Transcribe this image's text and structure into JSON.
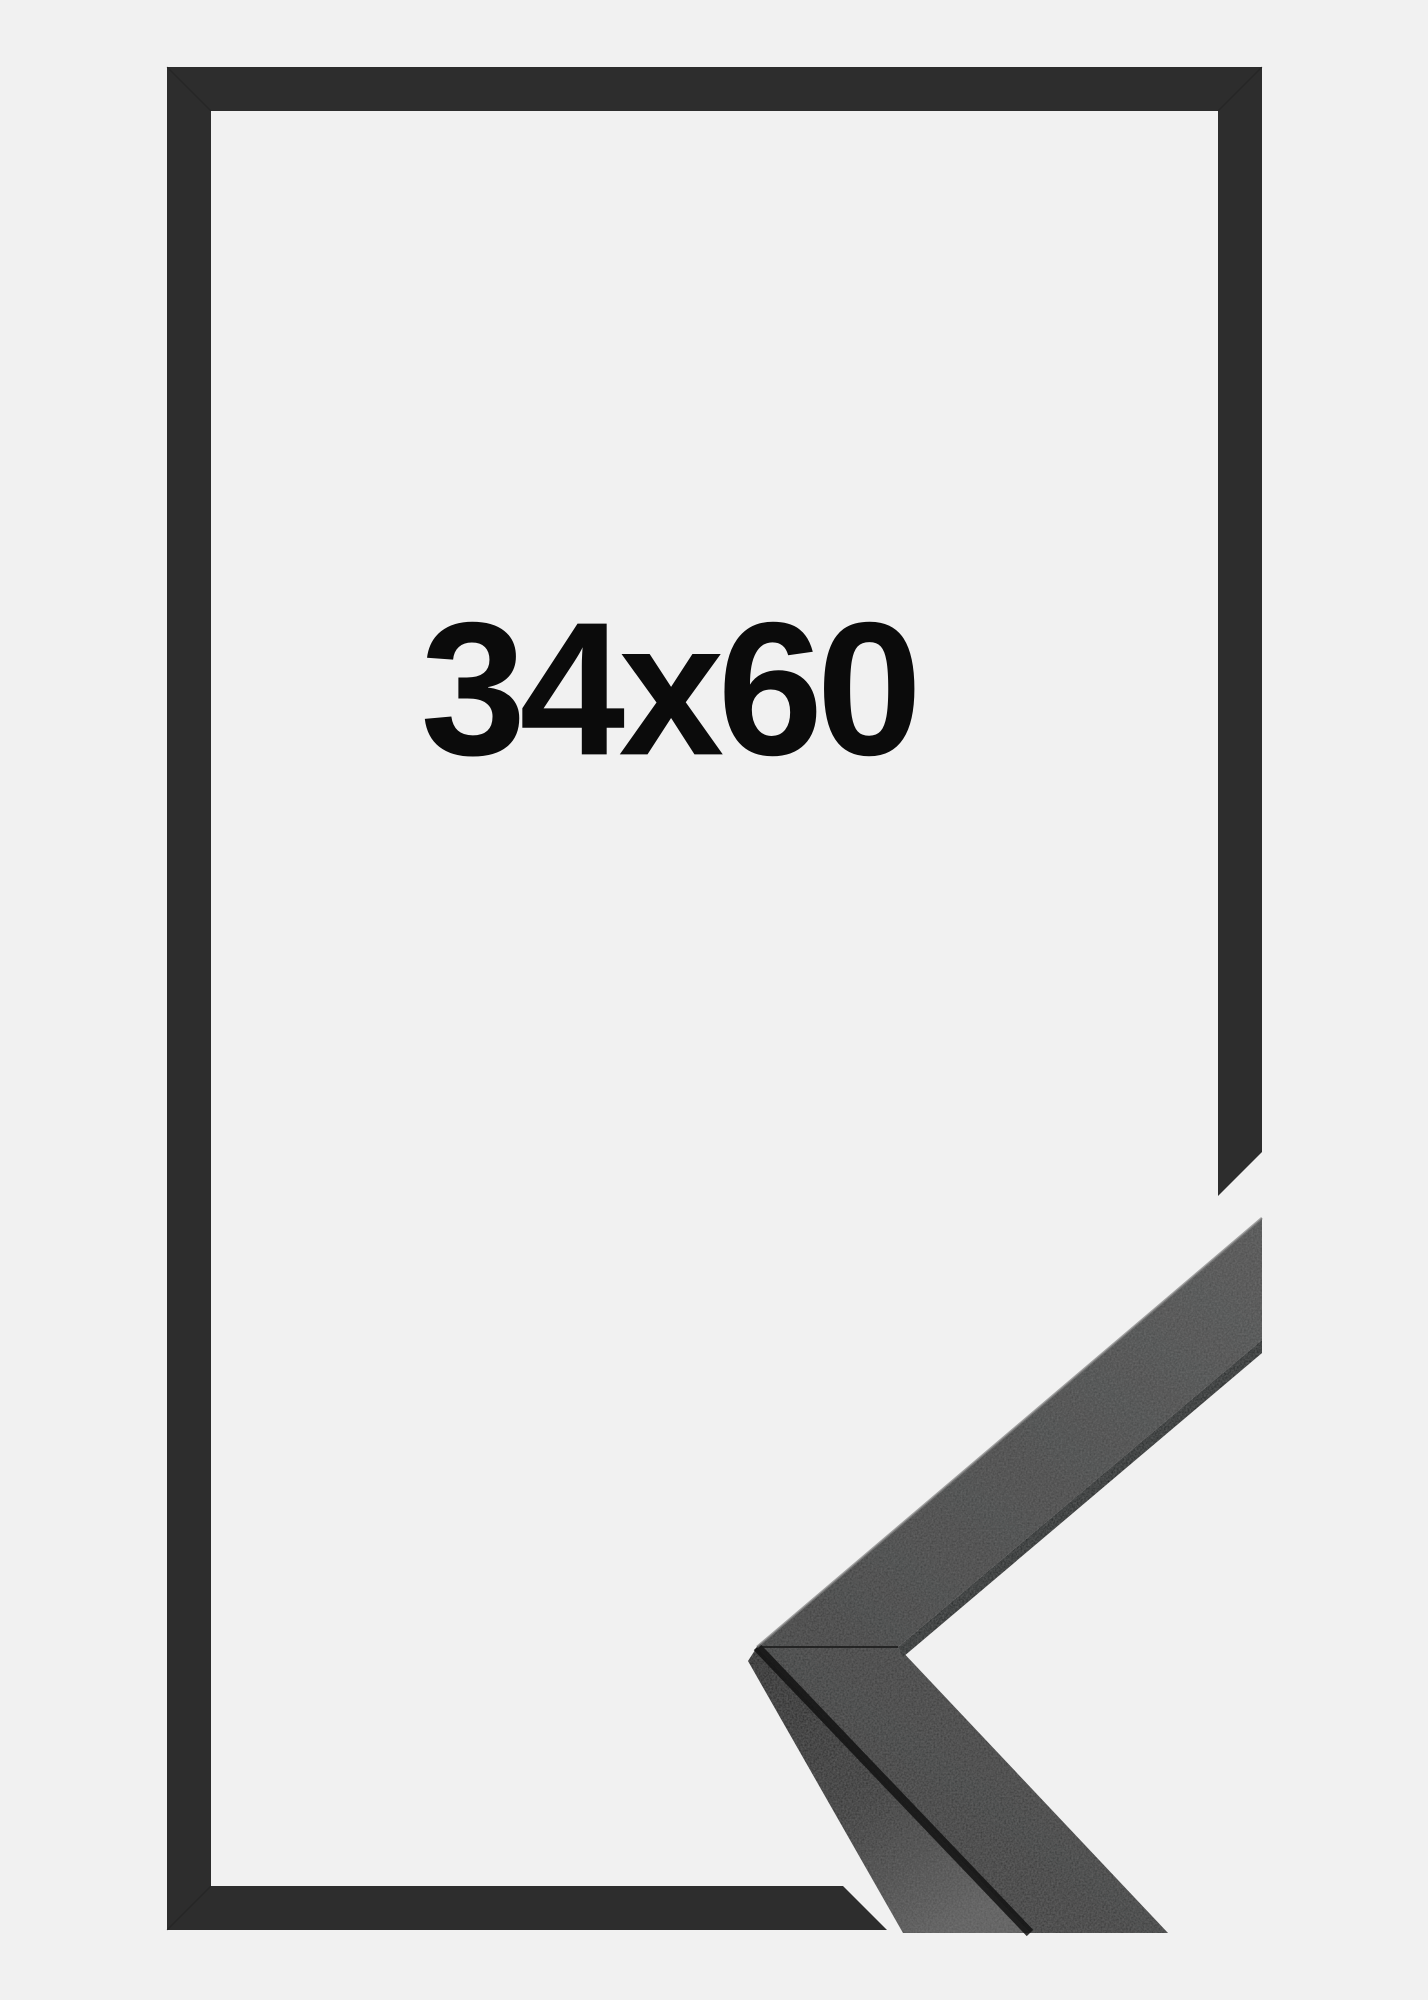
{
  "product_image": {
    "size_label": "34x60",
    "description": "black picture frame, flat outline view with 3D mitered corner close-up in lower right"
  },
  "colors": {
    "bg": "#f1f1f1",
    "frame": "#2d2d2d",
    "label": "#0b0b0b",
    "face-dark": "#2f2f2f",
    "face-mid": "#3c3d3d",
    "face-light": "#4a4b4b",
    "side-dark": "#1c1c1c",
    "side-light": "#575757",
    "strip": "#1f2020",
    "crease": "#121212",
    "seam": "#1a1a1a",
    "edge-highlight": "#7e7e7e"
  }
}
